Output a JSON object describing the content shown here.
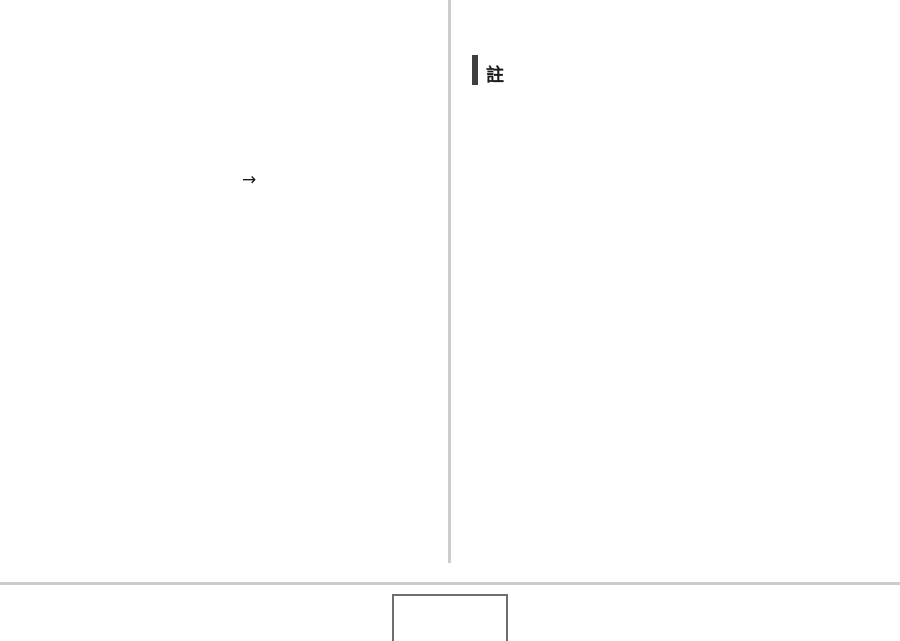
{
  "page": {
    "background": "#ffffff"
  },
  "left_column": {
    "arrow_glyph": "→"
  },
  "right_column": {
    "note_heading": "註"
  },
  "colors": {
    "column_divider": "#cccccc",
    "footer_rule": "#cccccc",
    "note_heading_bar": "#3f3f3f",
    "heading_text": "#1a1a1a",
    "page_number_box_border": "#6e6e6e"
  }
}
